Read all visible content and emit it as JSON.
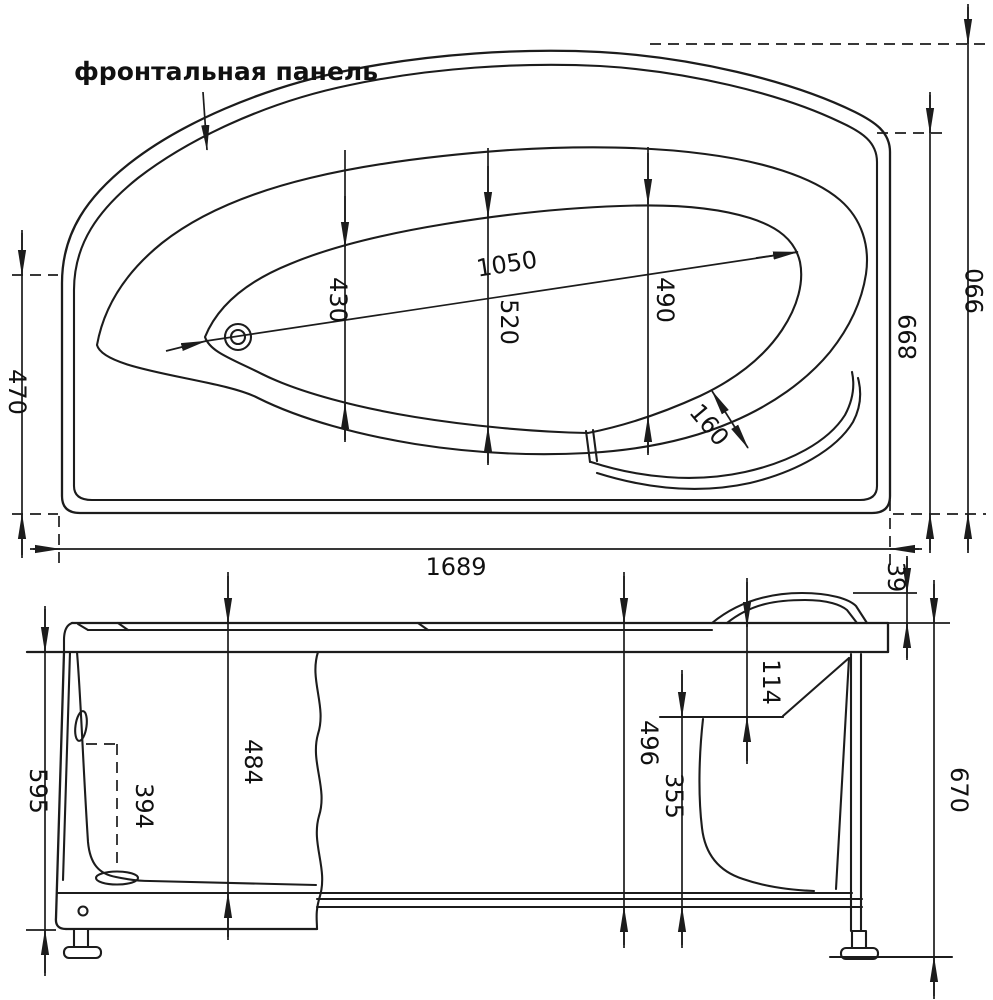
{
  "labels": {
    "front_panel": "фронтальная панель",
    "top": {
      "d470": "470",
      "d1689": "1689",
      "d1050": "1050",
      "d430": "430",
      "d520": "520",
      "d490": "490",
      "d160": "160",
      "d899": "899",
      "d990": "990"
    },
    "side": {
      "d595": "595",
      "d394": "394",
      "d484": "484",
      "d496": "496",
      "d355": "355",
      "d114": "114",
      "d39": "39",
      "d670": "670"
    }
  }
}
